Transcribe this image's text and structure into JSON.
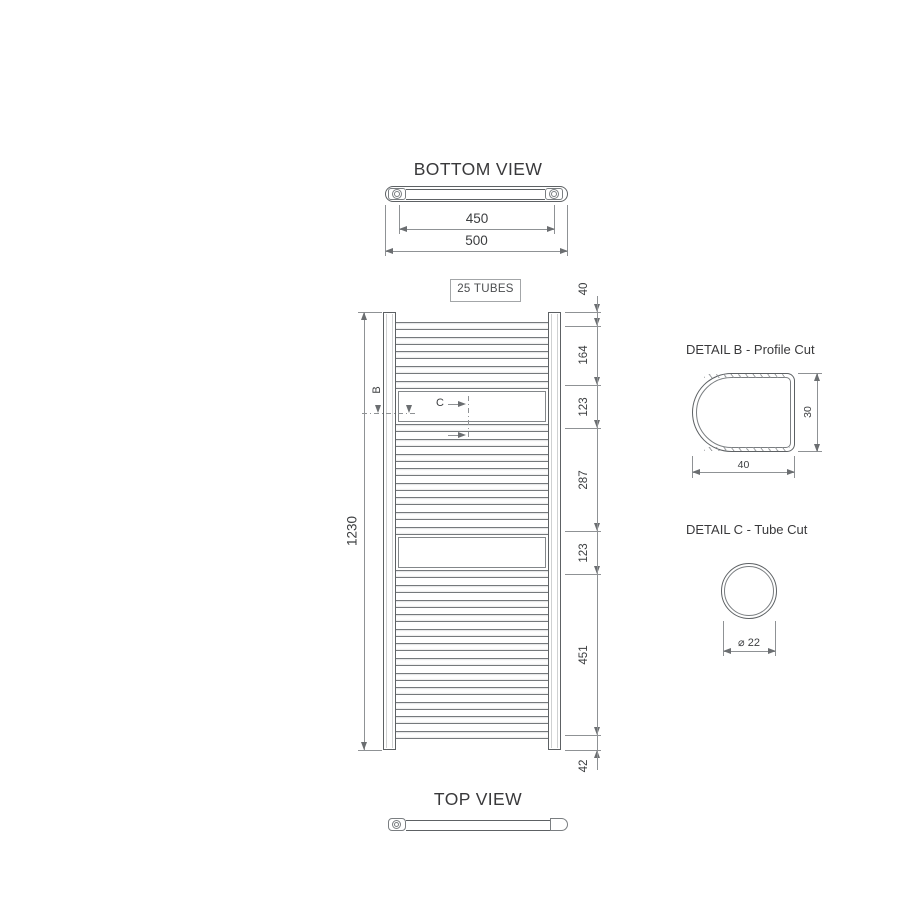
{
  "views": {
    "bottom_view": {
      "title": "BOTTOM VIEW",
      "dim_inner": "450",
      "dim_outer": "500"
    },
    "front_view": {
      "tubes_label": "25 TUBES",
      "height_dim": "1230",
      "right_chain": [
        {
          "label": "40",
          "mm": 40
        },
        {
          "label": "164",
          "mm": 164
        },
        {
          "label": "123",
          "mm": 123
        },
        {
          "label": "287",
          "mm": 287
        },
        {
          "label": "123",
          "mm": 123
        },
        {
          "label": "451",
          "mm": 451
        },
        {
          "label": "42",
          "mm": 42
        }
      ],
      "tube_groups": [
        5,
        8,
        12
      ],
      "section_b_label": "B",
      "section_c_label": "C"
    },
    "detail_b": {
      "title": "DETAIL B - Profile Cut",
      "width_dim": "40",
      "height_dim": "30"
    },
    "detail_c": {
      "title": "DETAIL C - Tube Cut",
      "diameter_dim": "⌀ 22"
    },
    "top_view": {
      "title": "TOP VIEW"
    }
  },
  "colors": {
    "outline": "#5d6164",
    "dim_line": "#8f9295",
    "text": "#3c3e40",
    "background": "#ffffff"
  }
}
